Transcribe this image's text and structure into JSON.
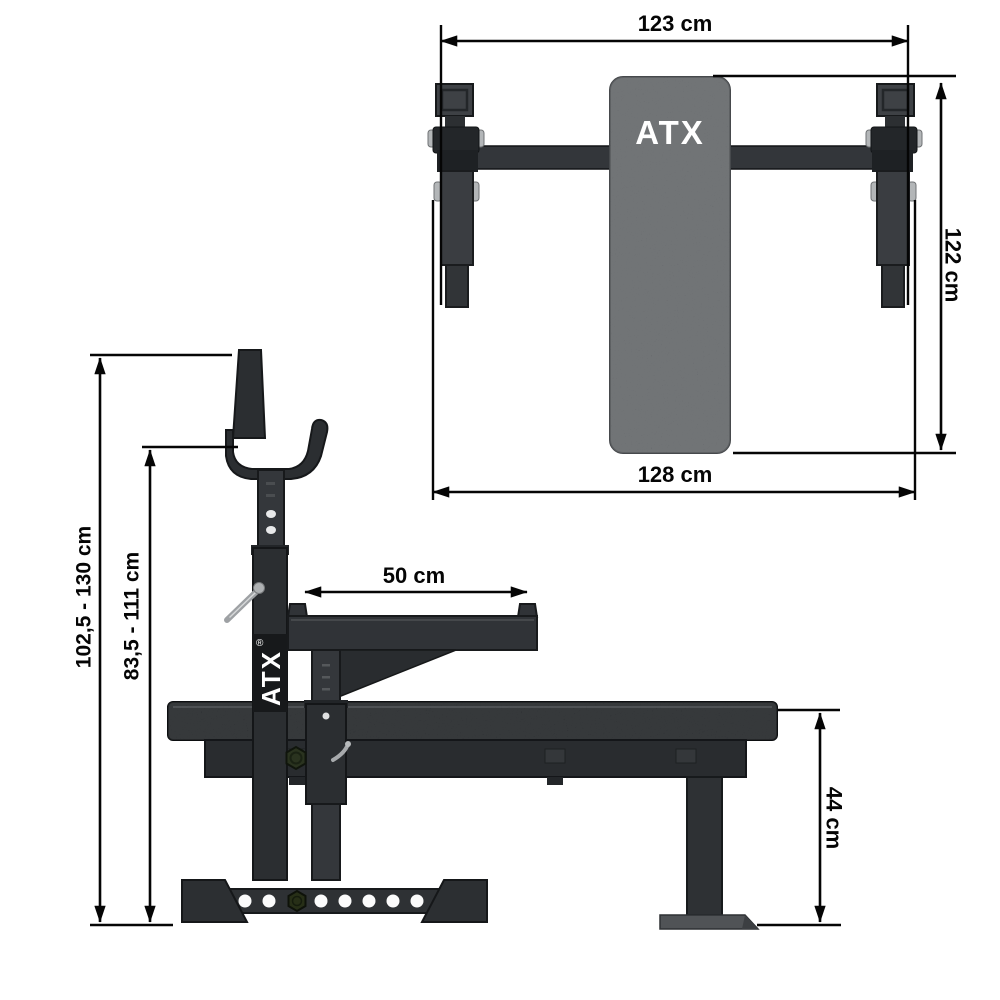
{
  "document": {
    "type": "product-dimension-drawing",
    "background": "#ffffff"
  },
  "brand": {
    "name": "ATX",
    "registered_mark": "®",
    "logo_color": "#ffffff"
  },
  "colors": {
    "dimension_lines": "#050505",
    "frame_dark": "#2b2e31",
    "frame_mid": "#3a3d41",
    "pad_top_view": "#5c5f62",
    "pad_side_view": "#1f2225",
    "metal_silver": "#a7aaac",
    "foot_gray": "#505356"
  },
  "top_view": {
    "name": "bench top view",
    "logo": "ATX",
    "dimensions": {
      "inner_width": {
        "label": "123 cm"
      },
      "length": {
        "label": "122 cm"
      },
      "outer_width": {
        "label": "128 cm"
      }
    }
  },
  "side_view": {
    "name": "bench side view",
    "logo": "ATX",
    "registered": "®",
    "dimensions": {
      "uprights_height": {
        "label": "102,5 - 130 cm"
      },
      "hook_height": {
        "label": "83,5 - 111 cm"
      },
      "deck_length": {
        "label": "50 cm"
      },
      "bench_height": {
        "label": "44 cm"
      }
    }
  }
}
